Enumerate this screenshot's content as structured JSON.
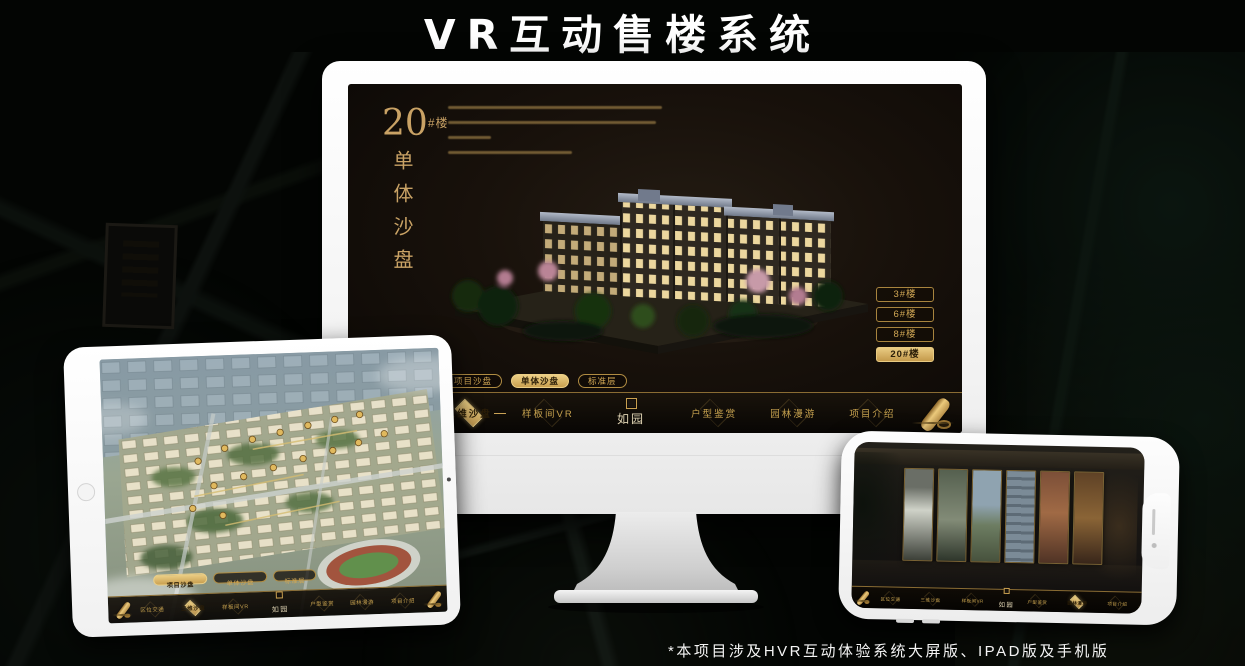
{
  "page": {
    "title": "VR互动售楼系统",
    "footnote": "*本项目涉及HVR互动体验系统大屏版、IPAD版及手机版"
  },
  "accent_colors": {
    "gold": "#c9a050",
    "gold_bright": "#ecd086",
    "screen_bg": "#18110b",
    "selected_text": "#2a1d07"
  },
  "app_nav": {
    "items": [
      "区位交通",
      "三维沙盘",
      "样板间VR",
      "户型鉴赏",
      "园林漫游",
      "项目介绍"
    ],
    "logo": "如园"
  },
  "app_subtabs": [
    "项目沙盘",
    "单体沙盘",
    "标准层"
  ],
  "monitor": {
    "heading": {
      "number": "20",
      "suffix": "#楼",
      "subtitle": "单体沙盘"
    },
    "building_buttons": [
      {
        "label": "3#楼",
        "selected": false
      },
      {
        "label": "6#楼",
        "selected": false
      },
      {
        "label": "8#楼",
        "selected": false
      },
      {
        "label": "20#楼",
        "selected": true
      }
    ],
    "subtab_selected": "单体沙盘",
    "nav_selected": "三维沙盘"
  },
  "tablet": {
    "subtab_selected": "项目沙盘",
    "nav_selected": "三维沙盘"
  },
  "phone": {
    "nav_selected": "园林漫游"
  }
}
